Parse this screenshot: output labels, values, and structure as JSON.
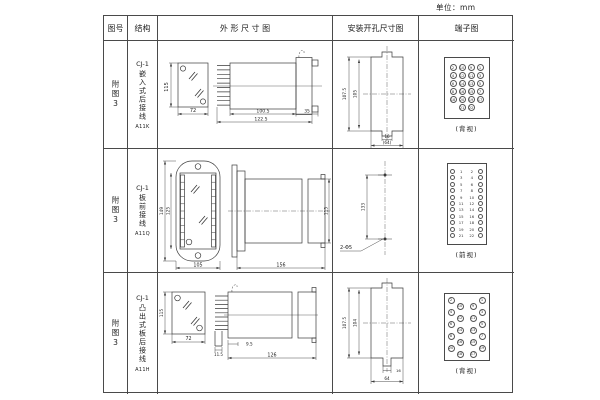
{
  "unit_label": "单位：mm",
  "header": {
    "fig_no": "图号",
    "structure": "结构",
    "outline": "外 形 尺 寸 图",
    "mounting": "安装开孔尺寸图",
    "terminal": "端子图"
  },
  "rows": [
    {
      "fig_no": "附图3",
      "model": "CJ-1",
      "desc": "嵌入式后接线",
      "code": "A11K",
      "outline": {
        "front_h": "115",
        "front_w": "72",
        "d1": "100.5",
        "d2": "122.5",
        "d3": "35"
      },
      "mounting": {
        "v1": "107.5",
        "v2": "105",
        "h1": "16",
        "h2": "(64)"
      },
      "terminal": {
        "view": "(背视)",
        "type": "grid",
        "rows": [
          [
            2,
            10,
            9,
            1
          ],
          [
            4,
            12,
            11,
            3
          ],
          [
            6,
            14,
            13,
            5
          ],
          [
            8,
            16,
            15,
            7
          ],
          [
            18,
            20,
            19,
            17
          ],
          [
            21,
            22
          ]
        ]
      }
    },
    {
      "fig_no": "附图3",
      "model": "CJ-1",
      "desc": "板前接线",
      "code": "A11Q",
      "outline": {
        "front_h1": "149",
        "front_h2": "125",
        "front_w": "105",
        "side_l": "156",
        "side_h": "115"
      },
      "mounting": {
        "v1": "133",
        "hole": "2-Φ5"
      },
      "terminal": {
        "view": "(前视)",
        "type": "twocol",
        "left": [
          1,
          3,
          5,
          7,
          9,
          11,
          13,
          15,
          17,
          19,
          21
        ],
        "right": [
          2,
          4,
          6,
          8,
          10,
          12,
          14,
          16,
          18,
          20,
          22
        ]
      }
    },
    {
      "fig_no": "附图3",
      "model": "CJ-1",
      "desc": "凸出式板后接线",
      "code": "A11H",
      "outline": {
        "front_h": "115",
        "front_w": "72",
        "d1": "11.5",
        "d2": "9.5",
        "d3": "126"
      },
      "mounting": {
        "v1": "107.5",
        "v2": "104",
        "h1": "16",
        "h2": "64"
      },
      "terminal": {
        "view": "(背视)",
        "type": "staggered",
        "cols": [
          [
            2,
            4,
            6,
            8,
            20
          ],
          [
            10,
            12,
            14,
            16,
            18
          ],
          [
            9,
            11,
            13,
            15,
            17
          ],
          [
            1,
            3,
            5,
            7,
            19
          ]
        ]
      }
    }
  ]
}
